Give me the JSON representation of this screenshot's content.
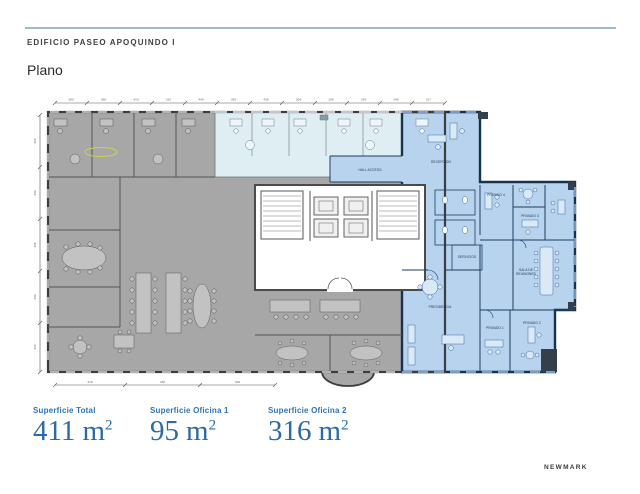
{
  "header": {
    "building_name": "EDIFICIO PASEO APOQUINDO I",
    "page_title": "Plano"
  },
  "plan": {
    "room_labels": {
      "recepcion": "RECEPCION",
      "hall_acceso": "HALL ACCESO",
      "privado_4": "PRIVADO 4",
      "privado_3": "PRIVADO 3",
      "servicios": "SERVICIOS",
      "sala_line1": "SALA DE",
      "sala_line2": "REUNIONES",
      "presidencia": "PRESIDENCIA",
      "privado_1": "PRIVADO 1",
      "privado_2": "PRIVADO 2"
    },
    "dims_top": [
      "380",
      "360",
      "410",
      "310",
      "440",
      "365",
      "438",
      "304",
      "280",
      "334",
      "348",
      "317"
    ],
    "dims_left": [
      "320",
      "330",
      "345",
      "330",
      "320"
    ],
    "dims_bottom": [
      "415",
      "330",
      "300"
    ],
    "colors": {
      "oficina_1_fill": "#dfeef2",
      "oficina_2_fill": "#b7d3ee",
      "ocupado_fill": "#a7a7a7"
    }
  },
  "stats": [
    {
      "label": "Superficie Total",
      "value": "411",
      "unit": "m",
      "sup": "2"
    },
    {
      "label": "Superficie Oficina 1",
      "value": "95",
      "unit": "m",
      "sup": "2"
    },
    {
      "label": "Superficie Oficina 2",
      "value": "316",
      "unit": "m",
      "sup": "2"
    }
  ],
  "footer": {
    "brand": "NEWMARK"
  }
}
